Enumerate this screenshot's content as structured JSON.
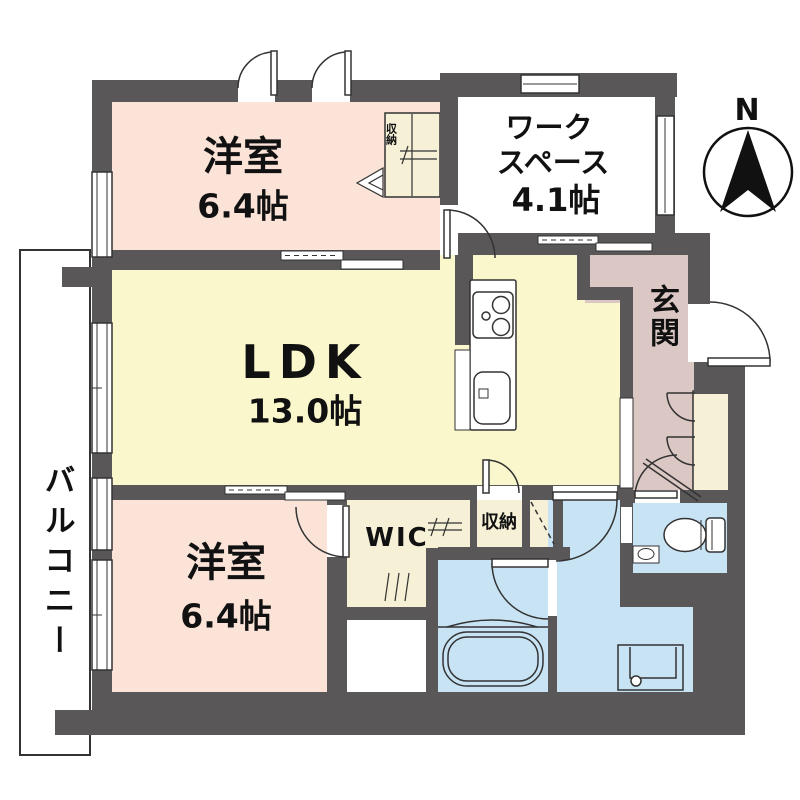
{
  "colors": {
    "wall": "#595757",
    "bedroom": "#fbe3d8",
    "ldk": "#f9f7cb",
    "closet": "#f5f0d6",
    "wet": "#c8e3f4",
    "entrance": "#dbc7c3"
  },
  "rooms": {
    "bedroom_top": {
      "name": "洋室",
      "area": "6.4帖"
    },
    "workspace": {
      "name_line1": "ワーク",
      "name_line2": "スペース",
      "area": "4.1帖"
    },
    "ldk": {
      "name": "LDK",
      "area": "13.0帖"
    },
    "entrance": {
      "name": "玄関"
    },
    "bedroom_bottom": {
      "name": "洋室",
      "area": "6.4帖"
    },
    "wic": {
      "name": "WIC"
    },
    "storage": {
      "name": "収納"
    },
    "closet_top": {
      "name": "収納"
    },
    "balcony": {
      "name": "バルコニー"
    }
  },
  "compass": {
    "label": "N"
  }
}
